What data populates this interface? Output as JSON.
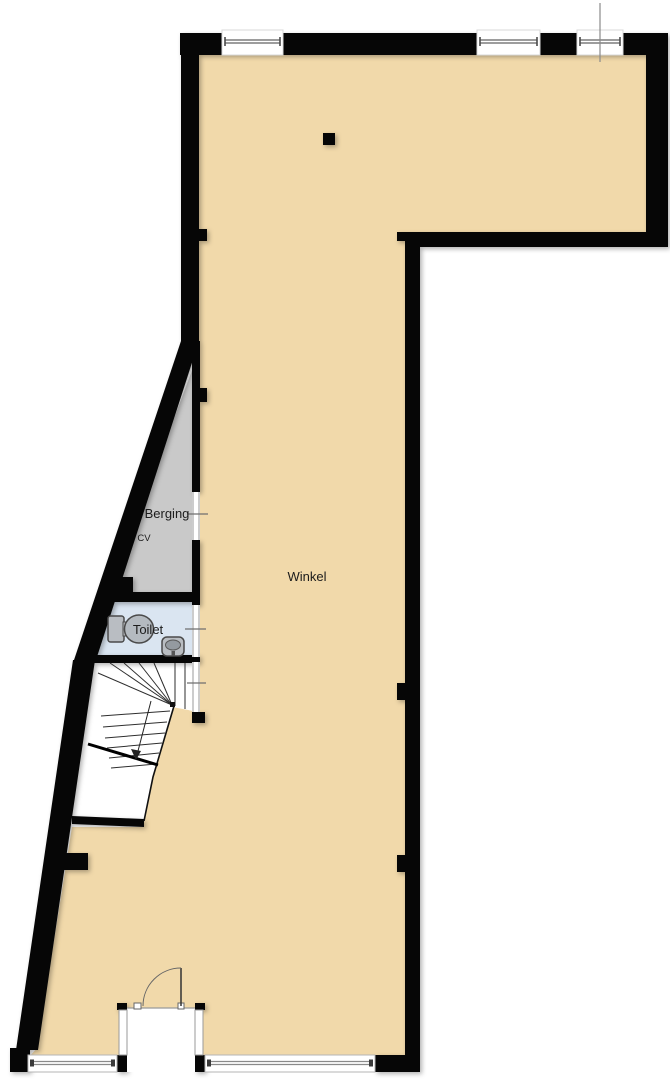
{
  "plan": {
    "type": "floorplan",
    "rooms": {
      "winkel": {
        "label": "Winkel"
      },
      "berging": {
        "label": "Berging"
      },
      "cv": {
        "label": "CV"
      },
      "toilet": {
        "label": "Toilet"
      }
    },
    "colors": {
      "wall": "#060606",
      "floor": "#f1d9aa",
      "berging": "#c9c9c9",
      "toilet": "#dae5f1",
      "white": "#ffffff",
      "frame": "#7d7d7d",
      "leader": "#6f6f6f"
    }
  }
}
